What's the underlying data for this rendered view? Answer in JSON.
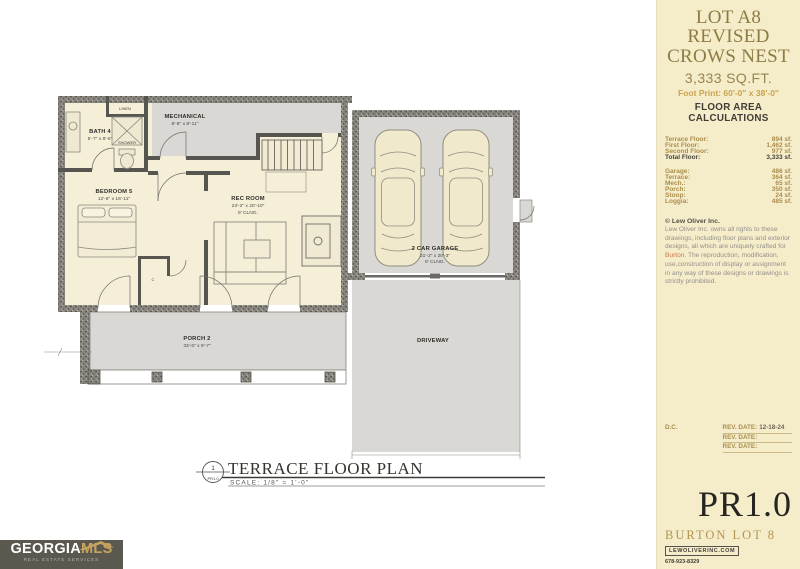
{
  "colors": {
    "sidebar_bg": "#f5ecca",
    "heading_olive": "#8d7b44",
    "gold": "#c9a54e",
    "table_tan": "#ab8d4a",
    "dark_text": "#3f3d36",
    "burton_orange": "#c8764a",
    "plan_cream": "#f6efd8",
    "plan_gray": "#d9d8d4",
    "logo_bg": "#5b5850",
    "logo_gold": "#c6a45d"
  },
  "sidebar": {
    "title_lines": [
      "LOT A8",
      "REVISED",
      "CROWS NEST"
    ],
    "sqft": "3,333 SQ.FT.",
    "footprint": "Foot Print: 60'-0\" x 38'-0\"",
    "section_heading": "FLOOR AREA CALCULATIONS",
    "floor_rows": [
      {
        "label": "Terrace Floor:",
        "value": "894 sf."
      },
      {
        "label": "First Floor:",
        "value": "1,462 sf."
      },
      {
        "label": "Second Floor:",
        "value": "977 sf."
      },
      {
        "label": "Total Floor:",
        "value": "3,333 sf."
      }
    ],
    "area_rows": [
      {
        "label": "Garage:",
        "value": "486 sf."
      },
      {
        "label": "Terrace:",
        "value": "364 sf."
      },
      {
        "label": "Mech.:",
        "value": "65 sf."
      },
      {
        "label": "Porch:",
        "value": "350 sf."
      },
      {
        "label": "Stoop:",
        "value": "24 sf."
      },
      {
        "label": "Loggia:",
        "value": "485 sf."
      }
    ],
    "copyright_heading": "© Lew Oliver Inc.",
    "copyright_pre": "Lew Oliver Inc. owns all rights to these drawings, including floor plans and exterior designs, all which are uniquely crafted for ",
    "copyright_name": "Burton",
    "copyright_post": ". The reproduction, modification, use,construction of display or assignment in any way of these designs or drawings is strictly prohibited.",
    "dc_label": "D.C.",
    "rev_rows": [
      {
        "label": "REV. DATE:",
        "date": "12-18-24"
      },
      {
        "label": "REV. DATE:",
        "date": ""
      },
      {
        "label": "REV. DATE:",
        "date": ""
      }
    ],
    "sheet_number": "PR1.0",
    "project_name": "BURTON LOT 8",
    "website": "LEWOLIVERINC.COM",
    "phone": "678-923-8329"
  },
  "plan": {
    "labels": {
      "linen": "LINEN",
      "mechanical": "MECHANICAL",
      "mechanical_dims": "8'-8\" x 8'-11\"",
      "bath": "BATH 4",
      "bath_dims": "5'-7\" x 8'-5\"",
      "shower": "SHOWER",
      "bedroom": "BEDROOM 5",
      "bedroom_dims": "12'-6\" x 16'-11\"",
      "recroom": "REC ROOM",
      "recroom_dims": "23'-2\" x 20'-10\"",
      "recroom_clng": "9' CLNG.",
      "closet": "C",
      "garage": "2 CAR GARAGE",
      "garage_dims": "21'-2\" x 20'-3\"",
      "garage_clng": "9' CLNG.",
      "porch": "PORCH 2",
      "porch_dims": "33'-6\" x 9'-7\"",
      "driveway": "DRIVEWAY"
    },
    "title": "TERRACE FLOOR PLAN",
    "scale": "SCALE: 1/8\" = 1'-0\"",
    "bubble_number": "1",
    "bubble_sheet": "PR1.0"
  },
  "logo": {
    "primary": "GEORGIA",
    "secondary": "MLS",
    "tagline": "REAL ESTATE SERVICES"
  }
}
